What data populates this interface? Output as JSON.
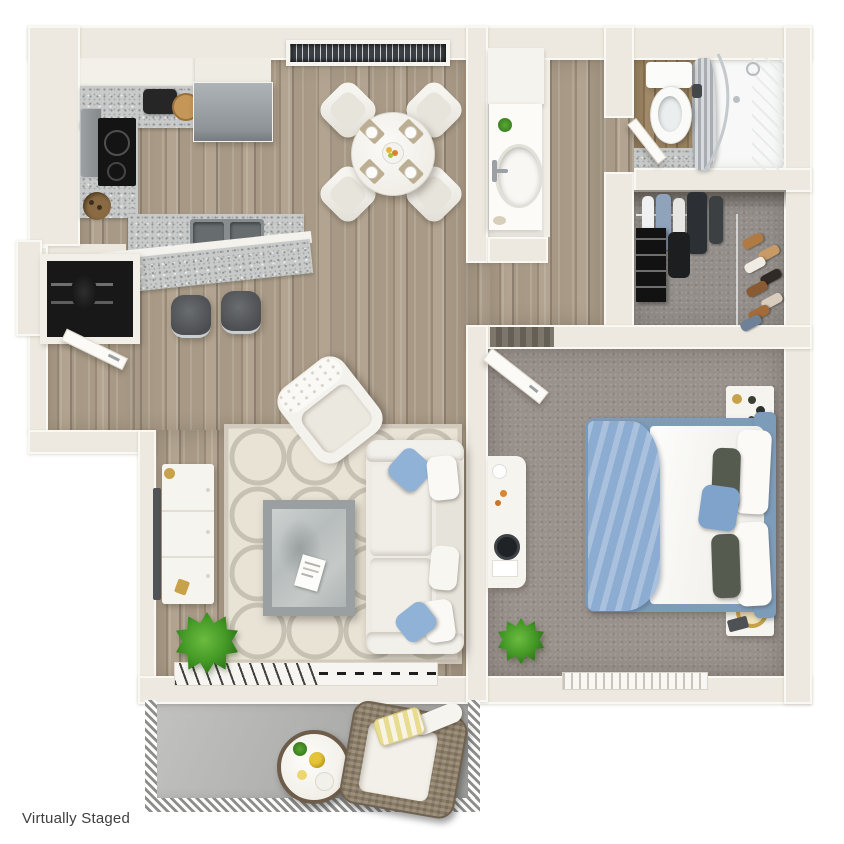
{
  "caption": {
    "label": "Virtually Staged"
  },
  "palette": {
    "background": "#ffffff",
    "wall": "#EDE9E0",
    "wall-trim": "#FAF8F3",
    "wood": "#A2947F",
    "granite": "#C8CAC9",
    "carpet": "#99918B",
    "closet-carpet": "#938E8A",
    "vanity-white": "#F6F4EF",
    "rug": "#E9E3D6",
    "rug-pattern": "#B2AB9E",
    "sofa": "#EDEBE4",
    "accent-blue": "#8FB2D6",
    "bed-frame": "#7D9CBA",
    "blanket-blue": "#8CACD2",
    "pillow-charcoal": "#565B50",
    "plant-green": "#3F9223",
    "stool-dark": "#54565A",
    "rattan": "#8A7B64",
    "balcony-floor": "#B3B3B1",
    "window-glass": "#3A3F43",
    "gold": "#C8A24B",
    "tv-dark": "#505456",
    "caption-color": "#3F3F3F"
  },
  "plan": {
    "rooms": [
      {
        "name": "kitchen",
        "furniture": [
          "refrigerator",
          "range",
          "cooktop",
          "double-sink",
          "granite-counter",
          "breakfast-bar",
          "bar-stool",
          "bar-stool",
          "cutting-board",
          "small-appliance"
        ]
      },
      {
        "name": "dining-area",
        "furniture": [
          "round-table",
          "dining-chair",
          "dining-chair",
          "dining-chair",
          "dining-chair",
          "place-setting",
          "place-setting",
          "place-setting",
          "place-setting",
          "fruit-bowl",
          "window"
        ]
      },
      {
        "name": "entry",
        "furniture": [
          "front-door",
          "utility-closet"
        ]
      },
      {
        "name": "powder-room",
        "furniture": [
          "vanity-counter",
          "oval-sink",
          "faucet",
          "potted-plant",
          "soap-dish",
          "upper-cabinet"
        ]
      },
      {
        "name": "bathroom",
        "furniture": [
          "toilet",
          "shower-tub",
          "shower-curtain",
          "curved-glass-door",
          "shower-head",
          "entry-door"
        ]
      },
      {
        "name": "walk-in-closet",
        "furniture": [
          "hanging-clothes",
          "shelf-tower",
          "shoe-rack"
        ]
      },
      {
        "name": "bedroom",
        "furniture": [
          "bed",
          "blue-throw-blanket",
          "pillows",
          "nightstand",
          "nightstand",
          "table-lamp",
          "flower-vase",
          "dresser",
          "potted-plant",
          "open-door",
          "window"
        ]
      },
      {
        "name": "living-room",
        "furniture": [
          "sofa",
          "accent-chair",
          "coffee-table",
          "magazine",
          "tv-console",
          "tv",
          "area-rug",
          "potted-plant",
          "window-blinds"
        ]
      },
      {
        "name": "balcony",
        "furniture": [
          "wicker-armchair",
          "round-side-table",
          "railing"
        ]
      }
    ]
  }
}
